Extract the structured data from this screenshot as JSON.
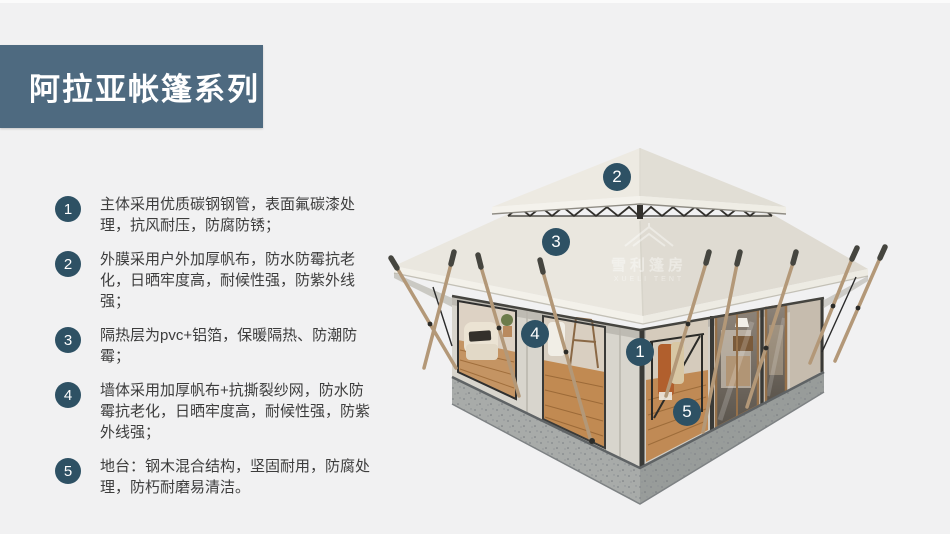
{
  "page": {
    "background_color": "#f1f1f2"
  },
  "banner": {
    "title": "阿拉亚帐篷系列",
    "bg_color": "#4e6a80",
    "text_color": "#ffffff"
  },
  "features": [
    {
      "num": "1",
      "text": "主体采用优质碳钢钢管，表面氟碳漆处理，抗风耐压，防腐防锈；"
    },
    {
      "num": "2",
      "text": "外膜采用户外加厚帆布，防水防霉抗老化，日晒牢度高，耐候性强，防紫外线强；"
    },
    {
      "num": "3",
      "text": "隔热层为pvc+铝箔，保暖隔热、防潮防霉；"
    },
    {
      "num": "4",
      "text": "墙体采用加厚帆布+抗撕裂纱网，防水防霉抗老化，日晒牢度高，耐候性强，防紫外线强；"
    },
    {
      "num": "5",
      "text": "地台：钢木混合结构，坚固耐用，防腐处理，防朽耐磨易清洁。"
    }
  ],
  "callouts": [
    {
      "num": "1"
    },
    {
      "num": "2"
    },
    {
      "num": "3"
    },
    {
      "num": "4"
    },
    {
      "num": "5"
    }
  ],
  "badge_color": "#2e5164",
  "watermark": {
    "cn": "雪利篷房",
    "en": "XUELI TENT",
    "icon": "tent-roof-icon"
  }
}
